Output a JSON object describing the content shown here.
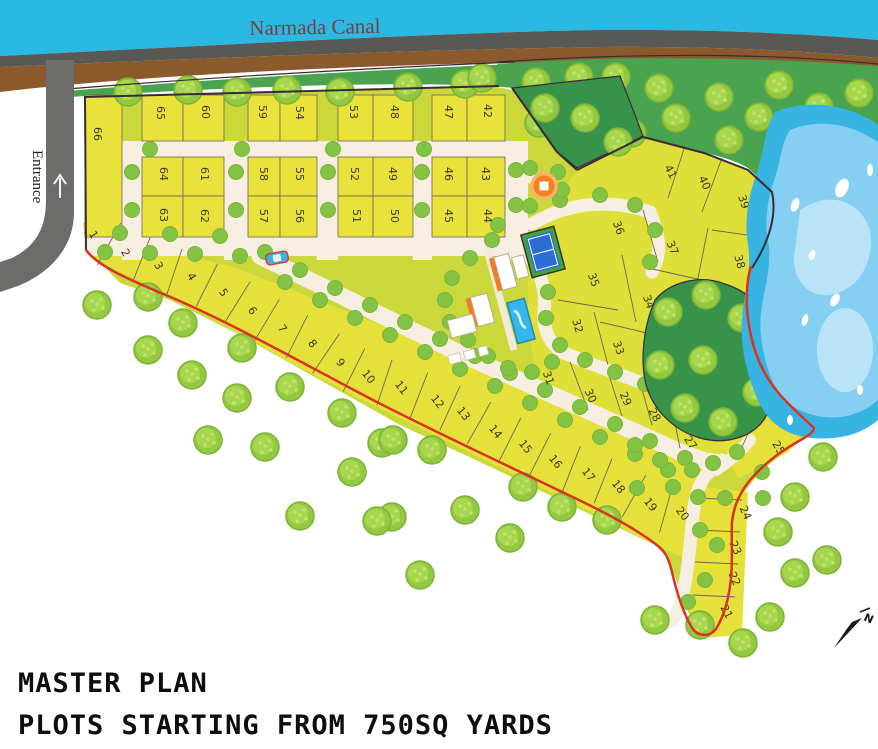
{
  "title": {
    "line1": "MASTER PLAN",
    "line2": "PLOTS STARTING FROM 750SQ YARDS"
  },
  "labels": {
    "canal": "Narmada Canal",
    "entrance": "Entrance",
    "compass_north": "N"
  },
  "colors": {
    "canal": "#2ab9e3",
    "canal_text": "#7d3c3c",
    "gray_band": "#585855",
    "brown_band": "#8a5a2c",
    "road_gray": "#6c6c6a",
    "green_field": "#4aa34f",
    "forest_dark": "#37924a",
    "estate_base": "#cbd83c",
    "plot_grid": "#e9e23b",
    "plot_band": "#e6e13a",
    "plot_cluster": "#dfdf3a",
    "road_cream": "#f6efe1",
    "boundary_red": "#d93222",
    "boundary_dark": "#3a2a33",
    "divider": "#6f6352",
    "lake_outer": "#38b4e2",
    "lake_mid": "#85cff2",
    "lake_light": "#b9e4f8",
    "tree_fill": "#93c840",
    "tree_inner": "#a6d74f",
    "tree_dot": "#c3e36a",
    "tree_stroke": "#7db339",
    "tree_small": "#82c344",
    "tennis_green": "#4aa03f",
    "tennis_blue": "#2b6fd6",
    "pool_blue": "#35b7ec",
    "building_orange": "#f07c28",
    "gazebo_orange": "#f08022",
    "car_blue": "#3bb3e8"
  },
  "map": {
    "canal_label_pos": {
      "x": 315,
      "y": 34
    },
    "entrance_label_pos": {
      "x": 33,
      "y": 150
    },
    "compass_pos": {
      "x": 850,
      "y": 632
    },
    "gazebo_pos": {
      "x": 544,
      "y": 186
    },
    "car_pos": {
      "x": 277,
      "y": 258,
      "rot": -10
    },
    "plots": [
      {
        "n": "66",
        "x": 97,
        "y": 134,
        "r": 90
      },
      {
        "n": "65",
        "x": 160,
        "y": 113,
        "r": 90
      },
      {
        "n": "60",
        "x": 205,
        "y": 112,
        "r": 90
      },
      {
        "n": "59",
        "x": 262,
        "y": 112,
        "r": 90
      },
      {
        "n": "54",
        "x": 299,
        "y": 113,
        "r": 90
      },
      {
        "n": "53",
        "x": 353,
        "y": 112,
        "r": 90
      },
      {
        "n": "48",
        "x": 394,
        "y": 112,
        "r": 90
      },
      {
        "n": "47",
        "x": 448,
        "y": 112,
        "r": 90
      },
      {
        "n": "42",
        "x": 487,
        "y": 111,
        "r": 90
      },
      {
        "n": "64",
        "x": 163,
        "y": 174,
        "r": 90
      },
      {
        "n": "61",
        "x": 204,
        "y": 174,
        "r": 90
      },
      {
        "n": "58",
        "x": 263,
        "y": 174,
        "r": 90
      },
      {
        "n": "55",
        "x": 299,
        "y": 174,
        "r": 90
      },
      {
        "n": "52",
        "x": 354,
        "y": 174,
        "r": 90
      },
      {
        "n": "49",
        "x": 392,
        "y": 174,
        "r": 90
      },
      {
        "n": "46",
        "x": 448,
        "y": 174,
        "r": 90
      },
      {
        "n": "43",
        "x": 485,
        "y": 174,
        "r": 90
      },
      {
        "n": "63",
        "x": 163,
        "y": 215,
        "r": 90
      },
      {
        "n": "62",
        "x": 204,
        "y": 216,
        "r": 90
      },
      {
        "n": "57",
        "x": 263,
        "y": 216,
        "r": 90
      },
      {
        "n": "56",
        "x": 299,
        "y": 216,
        "r": 90
      },
      {
        "n": "51",
        "x": 356,
        "y": 216,
        "r": 90
      },
      {
        "n": "50",
        "x": 394,
        "y": 216,
        "r": 90
      },
      {
        "n": "45",
        "x": 448,
        "y": 216,
        "r": 90
      },
      {
        "n": "44",
        "x": 487,
        "y": 216,
        "r": 90
      },
      {
        "n": "1",
        "x": 93,
        "y": 235,
        "r": 60
      },
      {
        "n": "2",
        "x": 125,
        "y": 253,
        "r": 60
      },
      {
        "n": "3",
        "x": 158,
        "y": 266,
        "r": 60
      },
      {
        "n": "4",
        "x": 191,
        "y": 277,
        "r": 58
      },
      {
        "n": "5",
        "x": 223,
        "y": 293,
        "r": 56
      },
      {
        "n": "6",
        "x": 252,
        "y": 311,
        "r": 55
      },
      {
        "n": "7",
        "x": 282,
        "y": 329,
        "r": 54
      },
      {
        "n": "8",
        "x": 312,
        "y": 344,
        "r": 52
      },
      {
        "n": "9",
        "x": 340,
        "y": 363,
        "r": 52
      },
      {
        "n": "10",
        "x": 368,
        "y": 377,
        "r": 52
      },
      {
        "n": "11",
        "x": 401,
        "y": 388,
        "r": 52
      },
      {
        "n": "12",
        "x": 437,
        "y": 402,
        "r": 52
      },
      {
        "n": "13",
        "x": 463,
        "y": 414,
        "r": 52
      },
      {
        "n": "14",
        "x": 495,
        "y": 432,
        "r": 52
      },
      {
        "n": "15",
        "x": 525,
        "y": 447,
        "r": 52
      },
      {
        "n": "16",
        "x": 555,
        "y": 462,
        "r": 52
      },
      {
        "n": "17",
        "x": 588,
        "y": 475,
        "r": 52
      },
      {
        "n": "18",
        "x": 618,
        "y": 487,
        "r": 52
      },
      {
        "n": "19",
        "x": 650,
        "y": 505,
        "r": 52
      },
      {
        "n": "20",
        "x": 682,
        "y": 514,
        "r": 52
      },
      {
        "n": "41",
        "x": 670,
        "y": 172,
        "r": 62
      },
      {
        "n": "40",
        "x": 704,
        "y": 183,
        "r": 66
      },
      {
        "n": "39",
        "x": 743,
        "y": 202,
        "r": 72
      },
      {
        "n": "36",
        "x": 618,
        "y": 228,
        "r": 70
      },
      {
        "n": "37",
        "x": 672,
        "y": 248,
        "r": 66
      },
      {
        "n": "38",
        "x": 739,
        "y": 262,
        "r": 75
      },
      {
        "n": "35",
        "x": 593,
        "y": 280,
        "r": 70
      },
      {
        "n": "34",
        "x": 648,
        "y": 302,
        "r": 70
      },
      {
        "n": "32",
        "x": 577,
        "y": 326,
        "r": 74
      },
      {
        "n": "33",
        "x": 618,
        "y": 348,
        "r": 70
      },
      {
        "n": "31",
        "x": 548,
        "y": 378,
        "r": 70
      },
      {
        "n": "30",
        "x": 590,
        "y": 396,
        "r": 66
      },
      {
        "n": "29",
        "x": 625,
        "y": 399,
        "r": 66
      },
      {
        "n": "28",
        "x": 654,
        "y": 415,
        "r": 62
      },
      {
        "n": "27",
        "x": 690,
        "y": 443,
        "r": 56
      },
      {
        "n": "26",
        "x": 747,
        "y": 421,
        "r": 60
      },
      {
        "n": "25",
        "x": 778,
        "y": 448,
        "r": 60
      },
      {
        "n": "24",
        "x": 745,
        "y": 513,
        "r": 66
      },
      {
        "n": "23",
        "x": 735,
        "y": 548,
        "r": 66
      },
      {
        "n": "22",
        "x": 734,
        "y": 579,
        "r": 66
      },
      {
        "n": "21",
        "x": 726,
        "y": 612,
        "r": 62
      }
    ],
    "band_order": [
      "1",
      "2",
      "3",
      "4",
      "5",
      "6",
      "7",
      "8",
      "9",
      "10",
      "11",
      "12",
      "13",
      "14",
      "15",
      "16",
      "17",
      "18",
      "19",
      "20"
    ],
    "grid": {
      "plot66": [
        85,
        122,
        95,
        237
      ],
      "cols": [
        [
          142,
          183
        ],
        [
          183,
          224
        ],
        [
          248,
          280
        ],
        [
          280,
          317
        ],
        [
          338,
          373
        ],
        [
          373,
          413
        ],
        [
          432,
          467
        ],
        [
          467,
          505
        ]
      ],
      "rows": [
        [
          95,
          141
        ],
        [
          157,
          196
        ],
        [
          196,
          237
        ]
      ],
      "vroads": [
        [
          122,
          142
        ],
        [
          224,
          248
        ],
        [
          317,
          338
        ],
        [
          413,
          432
        ],
        [
          505,
          528
        ]
      ],
      "hroads": [
        [
          122,
          528,
          141,
          157
        ],
        [
          85,
          528,
          237,
          256
        ]
      ]
    },
    "band_fill_n": [
      [
        83,
        222
      ],
      [
        130,
        240
      ],
      [
        180,
        254
      ],
      [
        230,
        266
      ],
      [
        280,
        285
      ],
      [
        330,
        305
      ],
      [
        380,
        325
      ],
      [
        430,
        345
      ],
      [
        480,
        364
      ],
      [
        530,
        383
      ],
      [
        580,
        402
      ],
      [
        630,
        422
      ],
      [
        670,
        440
      ],
      [
        700,
        460
      ],
      [
        708,
        472
      ]
    ],
    "band_fill_s": [
      [
        86,
        252
      ],
      [
        120,
        272
      ],
      [
        165,
        292
      ],
      [
        225,
        325
      ],
      [
        290,
        362
      ],
      [
        355,
        396
      ],
      [
        420,
        428
      ],
      [
        485,
        460
      ],
      [
        550,
        492
      ],
      [
        615,
        524
      ],
      [
        655,
        545
      ],
      [
        690,
        560
      ],
      [
        705,
        520
      ]
    ],
    "strip2124": [
      [
        692,
        486
      ],
      [
        748,
        492
      ],
      [
        742,
        635
      ],
      [
        702,
        638
      ],
      [
        686,
        600
      ],
      [
        688,
        540
      ],
      [
        690,
        510
      ]
    ],
    "patch2526": [
      [
        718,
        402
      ],
      [
        762,
        388
      ],
      [
        800,
        440
      ],
      [
        788,
        452
      ],
      [
        756,
        470
      ],
      [
        738,
        478
      ],
      [
        724,
        448
      ]
    ],
    "cluster_poly": [
      [
        577,
        170
      ],
      [
        643,
        138
      ],
      [
        704,
        154
      ],
      [
        748,
        170
      ],
      [
        772,
        192
      ],
      [
        766,
        245
      ],
      [
        750,
        272
      ],
      [
        752,
        310
      ],
      [
        764,
        355
      ],
      [
        778,
        392
      ],
      [
        802,
        438
      ],
      [
        756,
        470
      ],
      [
        724,
        452
      ],
      [
        700,
        470
      ],
      [
        640,
        440
      ],
      [
        580,
        408
      ],
      [
        540,
        390
      ],
      [
        528,
        330
      ],
      [
        528,
        260
      ],
      [
        545,
        215
      ]
    ],
    "cluster_dividers": [
      [
        685,
        146,
        668,
        198
      ],
      [
        722,
        158,
        702,
        212
      ],
      [
        712,
        230,
        768,
        238
      ],
      [
        708,
        228,
        696,
        288
      ],
      [
        643,
        210,
        658,
        262
      ],
      [
        648,
        268,
        715,
        283
      ],
      [
        622,
        255,
        636,
        322
      ],
      [
        600,
        322,
        668,
        338
      ],
      [
        558,
        300,
        618,
        310
      ],
      [
        594,
        312,
        608,
        365
      ],
      [
        570,
        362,
        588,
        410
      ],
      [
        608,
        372,
        622,
        416
      ],
      [
        640,
        382,
        652,
        425
      ],
      [
        670,
        398,
        680,
        448
      ],
      [
        764,
        396,
        740,
        452
      ],
      [
        696,
        498,
        742,
        500
      ],
      [
        697,
        530,
        740,
        532
      ],
      [
        695,
        562,
        738,
        564
      ],
      [
        693,
        595,
        735,
        597
      ]
    ],
    "trees_big": [
      [
        128,
        92
      ],
      [
        188,
        90
      ],
      [
        237,
        92
      ],
      [
        287,
        90
      ],
      [
        340,
        92
      ],
      [
        408,
        87
      ],
      [
        465,
        84
      ],
      [
        482,
        78
      ],
      [
        536,
        82
      ],
      [
        579,
        77
      ],
      [
        616,
        77
      ],
      [
        659,
        88
      ],
      [
        719,
        97
      ],
      [
        779,
        85
      ],
      [
        859,
        93
      ],
      [
        539,
        123
      ],
      [
        586,
        117
      ],
      [
        676,
        118
      ],
      [
        759,
        117
      ],
      [
        819,
        107
      ],
      [
        869,
        145
      ],
      [
        566,
        140
      ],
      [
        632,
        133
      ],
      [
        729,
        140
      ],
      [
        97,
        305
      ],
      [
        148,
        297
      ],
      [
        183,
        323
      ],
      [
        148,
        350
      ],
      [
        242,
        348
      ],
      [
        192,
        375
      ],
      [
        237,
        398
      ],
      [
        290,
        387
      ],
      [
        208,
        440
      ],
      [
        265,
        447
      ],
      [
        342,
        413
      ],
      [
        382,
        443
      ],
      [
        352,
        472
      ],
      [
        393,
        440
      ],
      [
        432,
        450
      ],
      [
        465,
        510
      ],
      [
        392,
        517
      ],
      [
        523,
        487
      ],
      [
        562,
        507
      ],
      [
        607,
        520
      ],
      [
        300,
        516
      ],
      [
        377,
        521
      ],
      [
        420,
        575
      ],
      [
        510,
        538
      ],
      [
        823,
        457
      ],
      [
        795,
        497
      ],
      [
        778,
        532
      ],
      [
        770,
        617
      ],
      [
        743,
        643
      ],
      [
        700,
        625
      ],
      [
        655,
        620
      ],
      [
        795,
        573
      ],
      [
        827,
        560
      ]
    ],
    "trees_forest": [
      [
        668,
        312
      ],
      [
        706,
        295
      ],
      [
        742,
        318
      ],
      [
        765,
        350
      ],
      [
        757,
        392
      ],
      [
        723,
        422
      ],
      [
        685,
        408
      ],
      [
        660,
        365
      ],
      [
        703,
        360
      ],
      [
        545,
        108
      ],
      [
        585,
        118
      ],
      [
        618,
        142
      ]
    ],
    "trees_small": [
      [
        120,
        233
      ],
      [
        170,
        234
      ],
      [
        220,
        236
      ],
      [
        105,
        252
      ],
      [
        150,
        253
      ],
      [
        195,
        254
      ],
      [
        240,
        256
      ],
      [
        265,
        252
      ],
      [
        300,
        270
      ],
      [
        335,
        288
      ],
      [
        370,
        305
      ],
      [
        405,
        322
      ],
      [
        440,
        339
      ],
      [
        475,
        356
      ],
      [
        510,
        373
      ],
      [
        545,
        390
      ],
      [
        580,
        407
      ],
      [
        615,
        424
      ],
      [
        650,
        441
      ],
      [
        685,
        458
      ],
      [
        285,
        282
      ],
      [
        320,
        300
      ],
      [
        355,
        318
      ],
      [
        390,
        335
      ],
      [
        425,
        352
      ],
      [
        460,
        369
      ],
      [
        495,
        386
      ],
      [
        530,
        403
      ],
      [
        565,
        420
      ],
      [
        600,
        437
      ],
      [
        635,
        454
      ],
      [
        668,
        470
      ],
      [
        132,
        172
      ],
      [
        132,
        210
      ],
      [
        236,
        172
      ],
      [
        236,
        210
      ],
      [
        328,
        172
      ],
      [
        328,
        210
      ],
      [
        422,
        172
      ],
      [
        422,
        210
      ],
      [
        516,
        170
      ],
      [
        516,
        205
      ],
      [
        150,
        149
      ],
      [
        242,
        149
      ],
      [
        333,
        149
      ],
      [
        424,
        149
      ],
      [
        560,
        200
      ],
      [
        600,
        195
      ],
      [
        635,
        205
      ],
      [
        655,
        230
      ],
      [
        650,
        262
      ],
      [
        552,
        262
      ],
      [
        548,
        292
      ],
      [
        546,
        318
      ],
      [
        560,
        345
      ],
      [
        585,
        360
      ],
      [
        615,
        372
      ],
      [
        645,
        384
      ],
      [
        672,
        395
      ],
      [
        492,
        240
      ],
      [
        470,
        258
      ],
      [
        452,
        278
      ],
      [
        445,
        300
      ],
      [
        450,
        322
      ],
      [
        468,
        340
      ],
      [
        488,
        356
      ],
      [
        508,
        368
      ],
      [
        532,
        372
      ],
      [
        552,
        362
      ],
      [
        498,
        225
      ],
      [
        530,
        206
      ],
      [
        562,
        190
      ],
      [
        635,
        445
      ],
      [
        660,
        460
      ],
      [
        692,
        470
      ],
      [
        713,
        463
      ],
      [
        737,
        452
      ],
      [
        762,
        472
      ],
      [
        637,
        488
      ],
      [
        673,
        487
      ],
      [
        698,
        497
      ],
      [
        725,
        498
      ],
      [
        763,
        498
      ],
      [
        700,
        530
      ],
      [
        717,
        545
      ],
      [
        705,
        580
      ],
      [
        688,
        602
      ],
      [
        530,
        168
      ],
      [
        558,
        172
      ]
    ]
  }
}
